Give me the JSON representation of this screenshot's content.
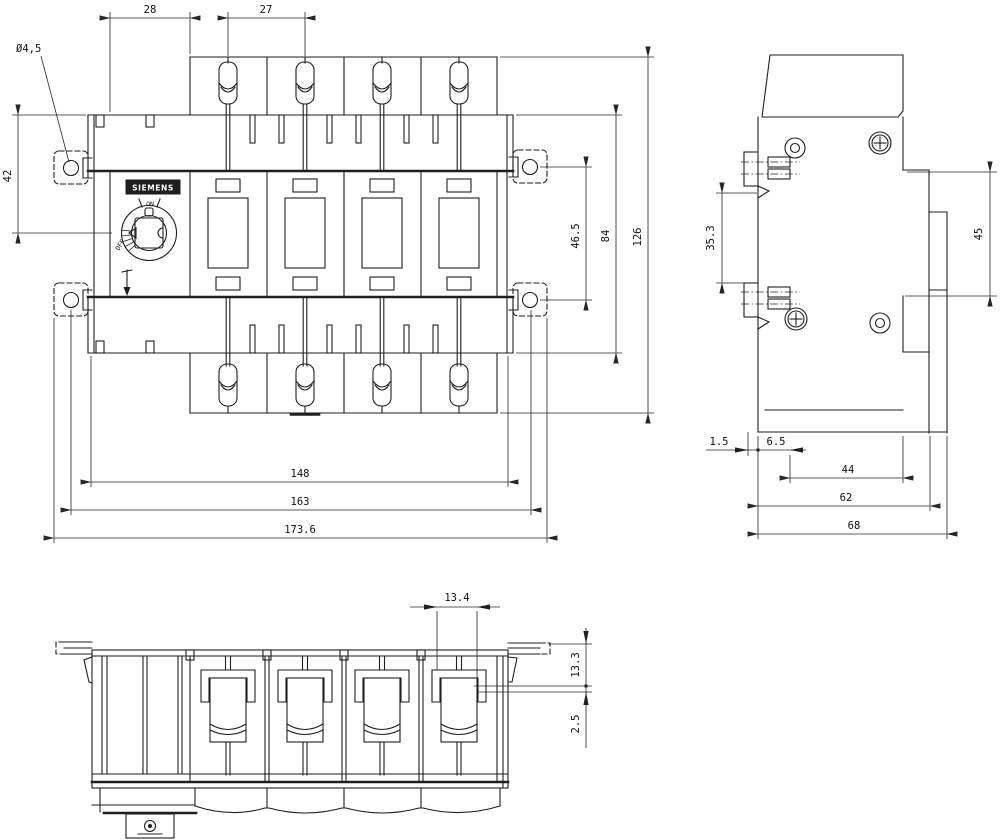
{
  "drawing": {
    "product": {
      "brand": "SIEMENS",
      "switch_on": "ON",
      "switch_off": "OFF"
    },
    "front_view": {
      "dims": {
        "flange_to_block": "28",
        "pole_pitch": "27",
        "mounting_hole": "Ø4,5",
        "top_to_center": "42",
        "hole_spacing": "46.5",
        "body_height": "84",
        "overall_height": "126",
        "inner_width": "148",
        "hole_span_width": "163",
        "overall_width": "173.6"
      }
    },
    "side_view": {
      "dims": {
        "terminal_gap": "35.3",
        "din_rail_height": "45",
        "rail_offset": "1.5",
        "front_offset": "6.5",
        "front_depth": "44",
        "body_depth": "62",
        "overall_depth": "68"
      }
    },
    "bottom_view": {
      "dims": {
        "clamp_width": "13.4",
        "clamp_depth": "13.3",
        "clamp_offset": "2.5"
      }
    }
  }
}
